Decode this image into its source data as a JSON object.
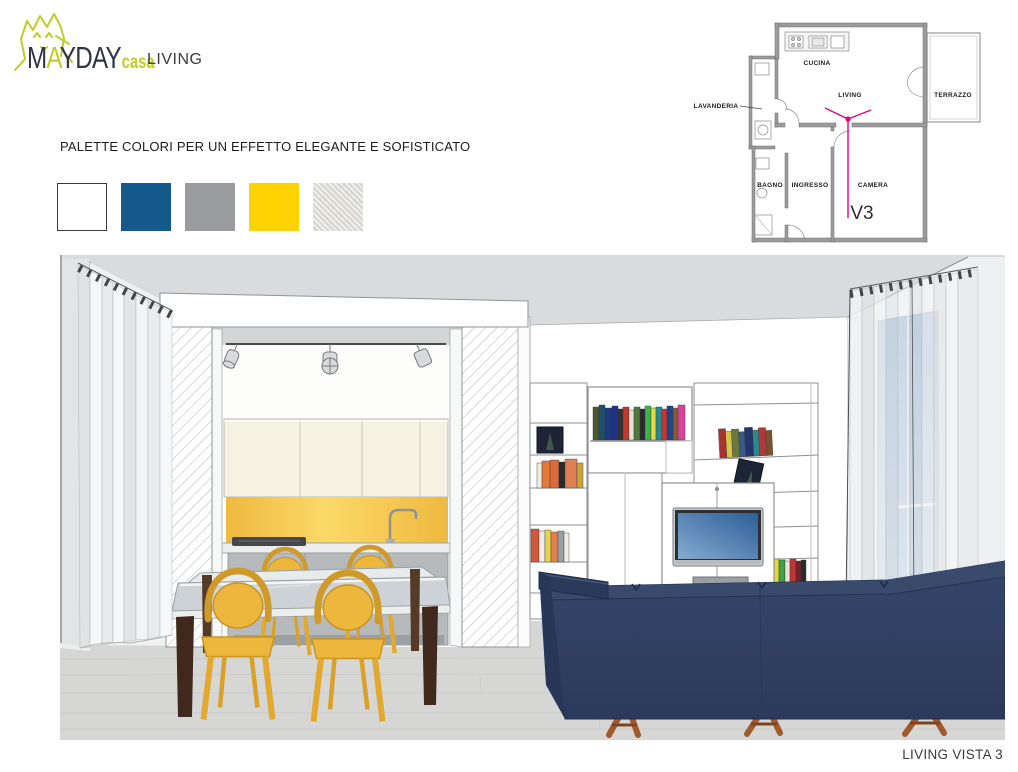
{
  "header": {
    "brand_part1": "M",
    "brand_part2": "A",
    "brand_part3": "YDAY",
    "brand_sub": "casa",
    "page_label": "LIVING"
  },
  "palette": {
    "title": "PALETTE COLORI PER UN EFFETTO ELEGANTE E SOFISTICATO",
    "swatches": [
      {
        "name": "bianco",
        "hex": "#ffffff"
      },
      {
        "name": "blu",
        "hex": "#15598b"
      },
      {
        "name": "grigio",
        "hex": "#9a9b9e"
      },
      {
        "name": "giallo",
        "hex": "#fdd304"
      },
      {
        "name": "grigio-chiaro-materico",
        "hex": "#dcdbd5"
      }
    ]
  },
  "floorplan": {
    "rooms": {
      "lavanderia": "LAVANDERIA",
      "cucina": "CUCINA",
      "living": "LIVING",
      "terrazzo": "TERRAZZO",
      "bagno": "BAGNO",
      "ingresso": "INGRESSO",
      "camera": "CAMERA"
    },
    "view_marker": "V3",
    "marker_color": "#e6007e"
  },
  "scene": {
    "colors": {
      "sofa": "#30405f",
      "chairs": "#ecb73c",
      "backsplash": "#f7cb4e",
      "window": "#a3bcd9",
      "floor": "#d6d7d5",
      "ceiling": "#d9dbdd"
    }
  },
  "footer": {
    "caption": "LIVING VISTA 3"
  }
}
